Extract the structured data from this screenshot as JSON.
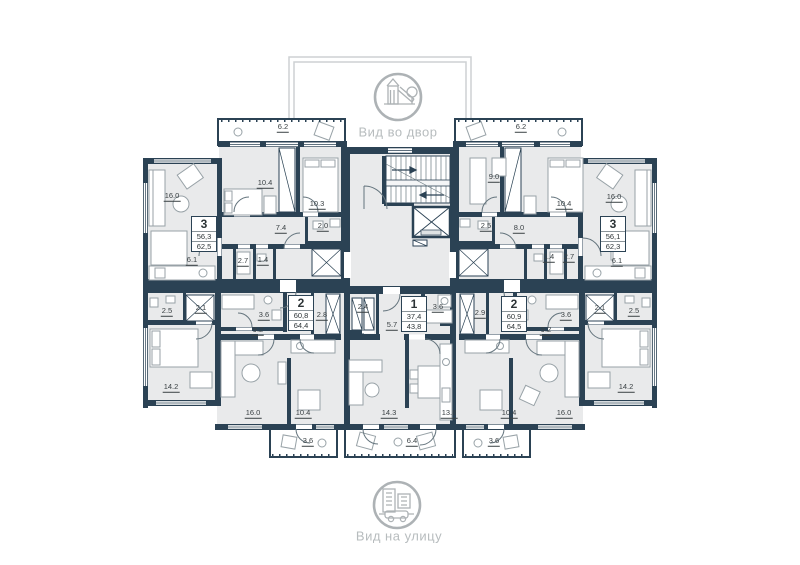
{
  "view_labels": {
    "courtyard": "Вид во двор",
    "street": "Вид на улицу"
  },
  "icons": {
    "courtyard": "playground-icon",
    "street": "street-buildings-icon",
    "stairs": "staircase-icon",
    "elevator": "elevator-icon"
  },
  "colors": {
    "wall": "#2b4254",
    "floor": "#e9eaeb",
    "muted_gray": "#adb2b5",
    "label": "#3a4144"
  },
  "apartments": [
    {
      "number": "3",
      "area1": "56,3",
      "area2": "62,5",
      "rooms": [
        "6.2",
        "16.0",
        "10.4",
        "10.3",
        "7.4",
        "2.0",
        "2.7",
        "1.4",
        "6.1"
      ]
    },
    {
      "number": "3",
      "area1": "56,1",
      "area2": "62,3",
      "rooms": [
        "6.2",
        "9.0",
        "10.4",
        "16.0",
        "2.5",
        "8.0",
        "1.4",
        "2.7",
        "6.1"
      ]
    },
    {
      "number": "2",
      "area1": "60,8",
      "area2": "64,4",
      "rooms": [
        "2.5",
        "2.1",
        "3.6",
        "9.2",
        "2.8",
        "14.2",
        "16.0",
        "10.4",
        "3.6"
      ]
    },
    {
      "number": "1",
      "area1": "37,4",
      "area2": "43,8",
      "rooms": [
        "2.4",
        "5.7",
        "3.6",
        "14.3",
        "13.8",
        "6.4"
      ]
    },
    {
      "number": "2",
      "area1": "60,9",
      "area2": "64,5",
      "rooms": [
        "2.9",
        "3.6",
        "2.1",
        "2.5",
        "9.2",
        "10.4",
        "16.0",
        "14.2",
        "3.6"
      ]
    }
  ]
}
